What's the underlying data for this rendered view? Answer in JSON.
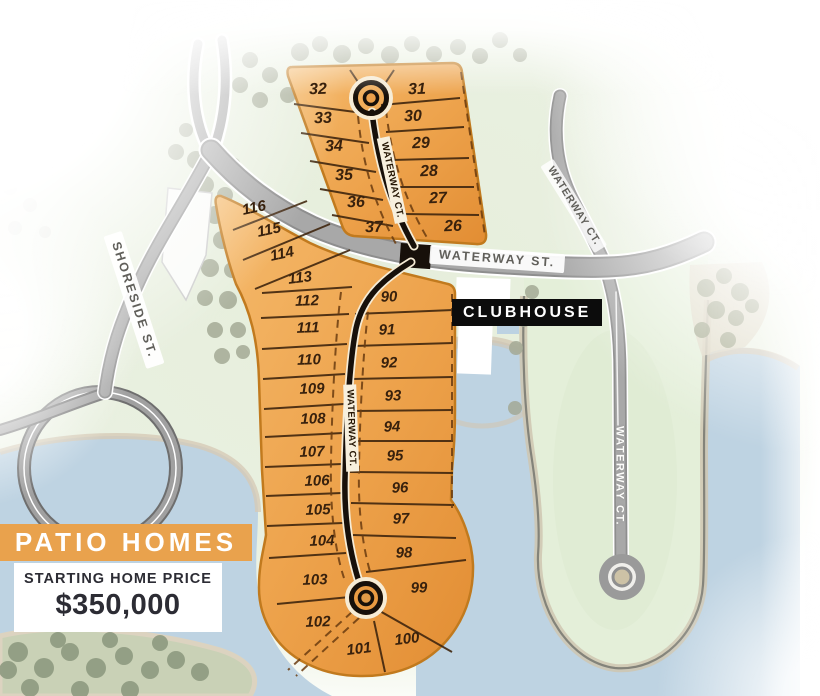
{
  "banner": {
    "label": "PATIO HOMES"
  },
  "pricing": {
    "heading": "STARTING HOME PRICE",
    "price": "$350,000"
  },
  "clubhouse": {
    "label": "CLUBHOUSE"
  },
  "streets": {
    "waterway_st": "WATERWAY ST.",
    "shoreside_st": "SHORESIDE ST.",
    "waterway_ct": "WATERWAY CT."
  },
  "lots": {
    "upper_left": [
      "32",
      "33",
      "34",
      "35",
      "36",
      "37"
    ],
    "upper_right": [
      "31",
      "30",
      "29",
      "28",
      "27",
      "26"
    ],
    "lower_left": [
      "116",
      "115",
      "114",
      "113",
      "112",
      "111",
      "110",
      "109",
      "108",
      "107",
      "106",
      "105",
      "104",
      "103",
      "102",
      "101"
    ],
    "lower_right": [
      "90",
      "91",
      "92",
      "93",
      "94",
      "95",
      "96",
      "97",
      "98",
      "99",
      "100"
    ]
  },
  "colors": {
    "lot_fill": "#EFA24E",
    "banner": "#E9A24D",
    "water": "#BDD2E2",
    "land": "#E7EFDC",
    "road": "#A6A6A6",
    "court_road": "#17100A",
    "clubhouse_bg": "#0D0D0D"
  }
}
